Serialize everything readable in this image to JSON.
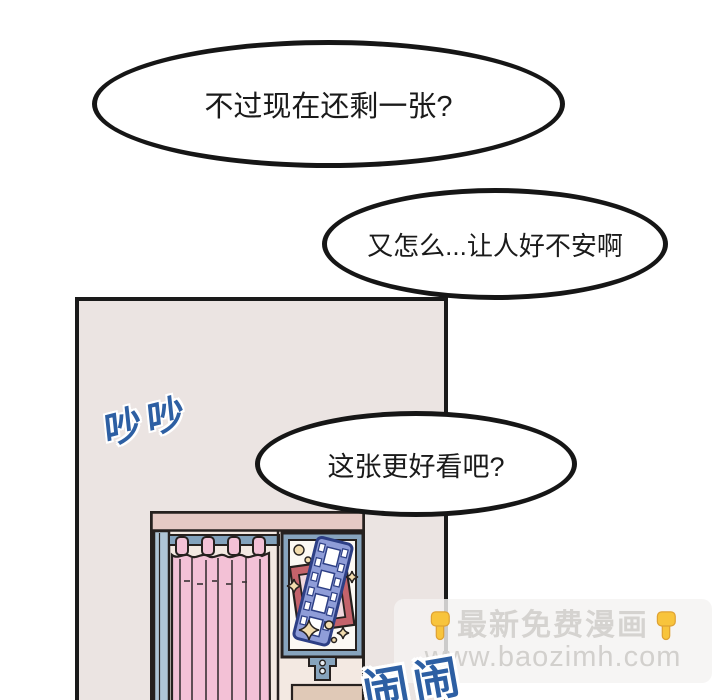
{
  "page": {
    "width": 720,
    "height": 700,
    "background": "#ffffff"
  },
  "bubbles": [
    {
      "text": "不过现在还剩一张?"
    },
    {
      "text": "又怎么...让人好不安啊"
    },
    {
      "text": "这张更好看吧?"
    }
  ],
  "panel": {
    "background": "#ebe4e2",
    "border_color": "#1a1a1a"
  },
  "sfx": {
    "chatter": "吵吵",
    "rattle": "闹闹",
    "color": "#2d5fa3"
  },
  "booth": {
    "body_color": "#f3e9e2",
    "top_bar_color": "#e6cac5",
    "curtain_color": "#f3c1d6",
    "trim_color": "#87a4bd",
    "poster_frame_color": "#c4636b",
    "film_strip_color": "#8f9dd8",
    "star_color": "#f2dcae",
    "slot_color": "#e0c9b7"
  },
  "watermark": {
    "line1": "最新免费漫画",
    "line2": "www.baozimh.com",
    "hand_icon": "backhand-index-pointing-down",
    "text_color": "#d5d3d0",
    "hand_color": "#f8c43c"
  }
}
